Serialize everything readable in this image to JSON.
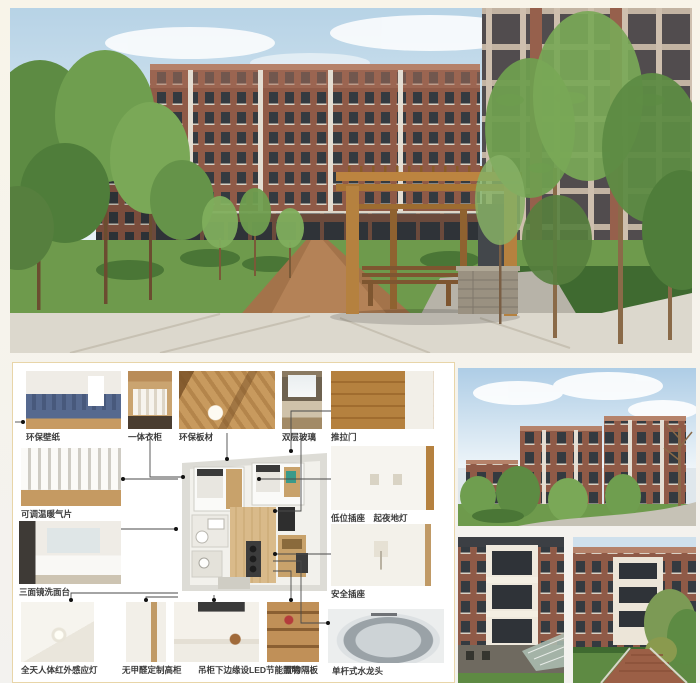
{
  "panel": {
    "callouts": {
      "wallpaper": "环保壁纸",
      "wardrobe": "一体衣柜",
      "board": "环保板材",
      "glazing": "双层玻璃",
      "sliding_door": "推拉门",
      "radiator": "可调温暖气片",
      "low_socket": "低位插座　起夜地灯",
      "safety_socket": "安全插座",
      "vanity": "三面镜洗面台",
      "sensor_light": "全天人体红外感应灯",
      "cabinet": "无甲醛定制高柜",
      "led": "吊柜下边缘设LED节能照明",
      "shelf": "置物隔板",
      "faucet": "单杆式水龙头"
    }
  },
  "colors": {
    "background": "#f4f2ec",
    "panel_border": "#e8d5a8",
    "brick": "#8f5a47",
    "wood": "#b5813f",
    "lawn": "#6e9a4c"
  }
}
